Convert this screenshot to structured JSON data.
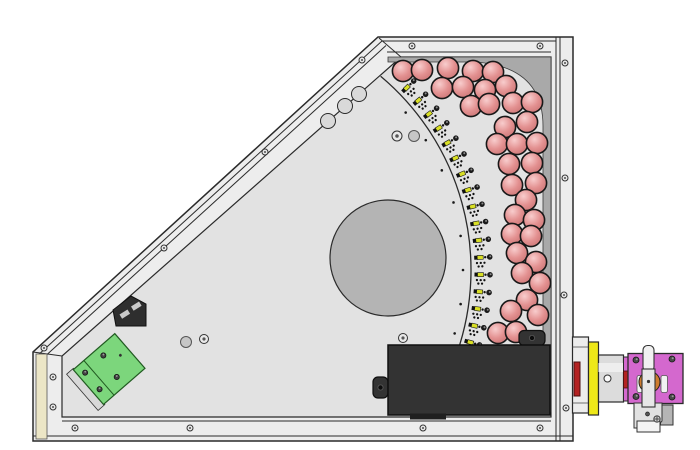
{
  "canvas": {
    "width": 700,
    "height": 450,
    "background": "#ffffff"
  },
  "palette": {
    "wall": "#ededed",
    "wall_line": "#2a2a2a",
    "plate": "#e2e2e2",
    "corner_patch": "#a9a9a9",
    "disc": "#b4b4b4",
    "sphere_hi": "#f8cdcd",
    "sphere_mid": "#e39191",
    "sphere_dark": "#c66e6e",
    "sphere_stroke": "#181818",
    "adjuster_yellow": "#d9df25",
    "pcb_green": "#7cd67c",
    "pcb_green_stroke": "#215a21",
    "silver": "#d8d8d8",
    "box_black": "#333333",
    "magenta": "#d468ce",
    "orange": "#cf7c2e",
    "yellow_plate": "#eee818",
    "red_port": "#b32222",
    "beige": "#ece6c6",
    "screw_fill": "#e9e9e9",
    "screw_stroke": "#333333"
  },
  "enclosure": {
    "outline": "M 378 37 L 573 37 L 573 441 L 33 441 L 33 352 Z",
    "interior": "M 401 57 L 551 57 L 551 417 L 62 417 L 62 356 Z",
    "corner_patch": "M 388 57 L 551 57 L 551 412 L 543 412 L 543 126 Q 543 66 474 62 L 388 62 Z",
    "wall_lines": [
      "M 382 41 H 556",
      "M 387 52 H 551",
      "M 379 38 L 401 57",
      "M 556 37 V 441",
      "M 560 37 V 441",
      "M 62 421 H 551",
      "M 33 436 H 573",
      "M 33 352 L 62 356",
      "M 382 41 L 37 356",
      "M 386 45.5 L 41 360"
    ],
    "beige_strip": {
      "x": 36,
      "y": 354,
      "w": 11,
      "h": 85
    },
    "scallops": {
      "r": 7.5,
      "centers": [
        [
          359,
          94
        ],
        [
          345,
          106
        ],
        [
          328,
          121
        ]
      ]
    },
    "screws": {
      "r": 3,
      "top_wall": [
        [
          412,
          46
        ],
        [
          540,
          46
        ]
      ],
      "right_wall": [
        [
          565,
          63
        ],
        [
          565,
          178
        ],
        [
          564,
          295
        ],
        [
          566,
          408
        ]
      ],
      "bottom_wall": [
        [
          75,
          428
        ],
        [
          190,
          428
        ],
        [
          423,
          428
        ],
        [
          540,
          428
        ]
      ],
      "diagonal_wall": [
        [
          362,
          60
        ],
        [
          265,
          152
        ],
        [
          164,
          248
        ],
        [
          44,
          348
        ]
      ],
      "left_wall": [
        [
          53,
          377
        ],
        [
          53,
          407
        ]
      ]
    }
  },
  "arc_line": {
    "cx": 218,
    "cy": 270,
    "r": 253,
    "start_deg": -50,
    "end_deg": 19.2
  },
  "inner_dots": {
    "cx": 218,
    "cy": 270,
    "radius": 245,
    "dot_r": 1.3,
    "angles": [
      -40,
      -32,
      -24,
      -16,
      -8,
      0,
      8,
      15
    ]
  },
  "adjusters": {
    "cx": 218,
    "cy": 270,
    "radius": 267,
    "start_deg": -44,
    "end_deg": 16,
    "count": 17
  },
  "spheres": {
    "r": 10.6,
    "positions": [
      [
        403,
        71
      ],
      [
        422,
        70
      ],
      [
        448,
        68
      ],
      [
        473,
        71
      ],
      [
        493,
        72
      ],
      [
        442,
        88
      ],
      [
        463,
        87
      ],
      [
        485,
        90
      ],
      [
        506,
        86
      ],
      [
        471,
        106
      ],
      [
        489,
        104
      ],
      [
        513,
        103
      ],
      [
        532,
        102
      ],
      [
        505,
        127
      ],
      [
        527,
        122
      ],
      [
        497,
        144
      ],
      [
        517,
        144
      ],
      [
        537,
        143
      ],
      [
        509,
        164
      ],
      [
        532,
        163
      ],
      [
        512,
        185
      ],
      [
        536,
        183
      ],
      [
        526,
        200
      ],
      [
        515,
        215
      ],
      [
        534,
        220
      ],
      [
        512,
        234
      ],
      [
        531,
        236
      ],
      [
        517,
        253
      ],
      [
        536,
        262
      ],
      [
        522,
        273
      ],
      [
        540,
        283
      ],
      [
        527,
        300
      ],
      [
        511,
        311
      ],
      [
        538,
        315
      ],
      [
        498,
        333
      ],
      [
        516,
        332
      ]
    ]
  },
  "plate_features": [
    {
      "type": "disc",
      "c": [
        388,
        258
      ],
      "r": 58
    },
    {
      "type": "stud",
      "c": [
        414,
        136
      ],
      "r": 5.5
    },
    {
      "type": "ring",
      "c": [
        397,
        136
      ],
      "r": 5
    },
    {
      "type": "stud",
      "c": [
        186,
        342
      ],
      "r": 5.5
    },
    {
      "type": "ring",
      "c": [
        204,
        339
      ],
      "r": 4.5
    },
    {
      "type": "ring",
      "c": [
        403,
        338
      ],
      "r": 4.5
    }
  ],
  "corner_bracket": {
    "body": "M 113 310 L 131 296 L 146 304 L 146 326 L 116 326 Z",
    "slots": [
      "M 119.5 314.5 l 8 -5 l 2.6 4.2 l -8 5 Z",
      "M 131 306.5 l 8 -5 l 2.6 4.2 l -8 5 Z"
    ]
  },
  "pcb": {
    "cx": 108,
    "cy": 370,
    "rot": -41,
    "silver": {
      "x": -34,
      "y": -24,
      "w": 9,
      "h": 48
    },
    "board": {
      "x": -26,
      "y": -23,
      "w": 55,
      "h": 46
    },
    "divider_x": -12,
    "screws": [
      [
        -19,
        -13
      ],
      [
        -19,
        9
      ],
      [
        6,
        -14
      ],
      [
        2,
        11
      ]
    ],
    "small_dot": [
      19,
      -3
    ]
  },
  "black_box": {
    "tabs": [
      {
        "x": 373,
        "y": 377,
        "w": 15,
        "h": 21,
        "hole": [
          380.5,
          387.5
        ]
      },
      {
        "x": 519,
        "y": 330.5,
        "w": 26,
        "h": 15,
        "hole": [
          532,
          338
        ]
      }
    ],
    "body": {
      "x": 388,
      "y": 345,
      "w": 162,
      "h": 70
    },
    "under_strip": {
      "x": 410,
      "y": 413.5,
      "w": 36,
      "h": 6
    }
  },
  "output_assembly": [
    {
      "k": "rect",
      "n": "flange-block",
      "x": 572.5,
      "y": 337,
      "w": 16,
      "h": 76,
      "f": "#ededed",
      "s": "#2a2a2a",
      "sw": 1.2
    },
    {
      "k": "path",
      "n": "flange-seam",
      "d": "M 572.5 347 H 588.5 M 572.5 403 H 588.5",
      "f": "none",
      "s": "#444444",
      "sw": 0.8
    },
    {
      "k": "rect",
      "n": "red-aperture",
      "x": 574,
      "y": 362,
      "w": 6,
      "h": 34,
      "f": "#b32222",
      "s": "#4a0f0f",
      "sw": 1
    },
    {
      "k": "rect",
      "n": "yellow-plate",
      "x": 588.5,
      "y": 342,
      "w": 10,
      "h": 73,
      "f": "#eee818",
      "s": "#2a2a2a",
      "sw": 1.2
    },
    {
      "k": "rect",
      "n": "coupler-cylinder",
      "x": 598.5,
      "y": 355,
      "w": 25,
      "h": 47,
      "f": "#dcdcdc",
      "s": "#2a2a2a",
      "sw": 1.2
    },
    {
      "k": "rect",
      "n": "coupler-highlight",
      "x": 598.5,
      "y": 363,
      "w": 25,
      "h": 9,
      "f": "#eeeeee",
      "s": "none",
      "sw": 0
    },
    {
      "k": "circle",
      "n": "coupler-hole",
      "cx": 607.5,
      "cy": 378.5,
      "r": 3.5,
      "f": "#fafafa",
      "s": "#333333",
      "sw": 1
    },
    {
      "k": "rect",
      "n": "magenta-sliver",
      "x": 623.5,
      "y": 357,
      "w": 5,
      "h": 44,
      "f": "#d468ce",
      "s": "#2a2a2a",
      "sw": 1
    },
    {
      "k": "rect",
      "n": "red-sliver",
      "x": 623.5,
      "y": 371,
      "w": 4.5,
      "h": 17,
      "f": "#b32222",
      "s": "#4a0f0f",
      "sw": 0.8
    },
    {
      "k": "rect",
      "n": "magenta-block",
      "x": 628,
      "y": 353.5,
      "w": 55,
      "h": 50,
      "f": "#d468ce",
      "s": "#2a2a2a",
      "sw": 1.3
    },
    {
      "k": "screw4",
      "n": "block-screws",
      "pts": [
        [
          636,
          360
        ],
        [
          672,
          359
        ],
        [
          636,
          396.5
        ],
        [
          672,
          397
        ]
      ],
      "r": 3
    },
    {
      "k": "rect",
      "n": "block-slot-left",
      "x": 637,
      "y": 375.5,
      "w": 6.5,
      "h": 17,
      "rx": 2,
      "f": "#f2f2f2",
      "s": "#555555",
      "sw": 0.8
    },
    {
      "k": "rect",
      "n": "block-slot-right",
      "x": 661,
      "y": 375.5,
      "w": 6.5,
      "h": 17,
      "rx": 2,
      "f": "#f2f2f2",
      "s": "#555555",
      "sw": 0.8
    },
    {
      "k": "circle",
      "n": "orange-knob",
      "cx": 649.5,
      "cy": 382,
      "r": 10.5,
      "f": "#cf7c2e",
      "s": "#222222",
      "sw": 1
    },
    {
      "k": "rect",
      "n": "bracket-backing",
      "x": 660.5,
      "y": 405,
      "w": 12.5,
      "h": 20,
      "f": "#b5b5b5",
      "s": "#333333",
      "sw": 1
    },
    {
      "k": "path",
      "n": "bracket-plate",
      "d": "M 634 403 L 662 403 L 662 421 L 656 428 L 634 428 Z",
      "f": "#e2e2e2",
      "s": "#333333",
      "sw": 1
    },
    {
      "k": "rect",
      "n": "bracket-foot",
      "x": 637,
      "y": 421,
      "w": 23,
      "h": 11,
      "f": "#f4f4f4",
      "s": "#333333",
      "sw": 1
    },
    {
      "k": "circle",
      "n": "bracket-screw-small",
      "cx": 647.5,
      "cy": 414,
      "r": 2,
      "f": "#555555",
      "s": "#222222",
      "sw": 0.7
    },
    {
      "k": "circle",
      "n": "bracket-screw-large",
      "cx": 657,
      "cy": 419,
      "r": 3.2,
      "f": "#cccccc",
      "s": "#333333",
      "sw": 0.9
    },
    {
      "k": "path",
      "n": "bracket-screw-cross",
      "d": "M 654.2 419 H 659.8 M 657 416.2 V 421.8",
      "f": "none",
      "s": "#333333",
      "sw": 0.8
    },
    {
      "k": "rect",
      "n": "clamp-cylinder",
      "x": 643,
      "y": 345.5,
      "w": 11,
      "h": 26,
      "rx": 4.5,
      "f": "#f1f1f1",
      "s": "#333333",
      "sw": 1.1
    },
    {
      "k": "rect",
      "n": "clamp-bar",
      "x": 642,
      "y": 369,
      "w": 13,
      "h": 38,
      "f": "#e7e7e7",
      "s": "#333333",
      "sw": 1.1
    },
    {
      "k": "circle",
      "n": "clamp-bar-hole",
      "cx": 648.5,
      "cy": 381.5,
      "r": 1.6,
      "f": "#333333",
      "s": "none",
      "sw": 0
    }
  ]
}
